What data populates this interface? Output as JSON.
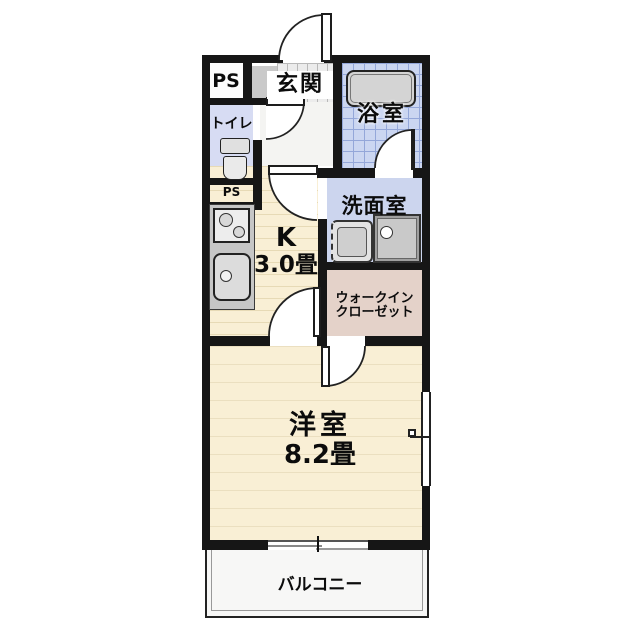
{
  "rooms": {
    "ps_top": {
      "label": "PS"
    },
    "entrance": {
      "label": "玄関"
    },
    "bathroom": {
      "label": "浴室"
    },
    "toilet": {
      "label": "トイレ"
    },
    "ps_lower": {
      "label": "PS"
    },
    "washroom": {
      "label": "洗面室"
    },
    "kitchen": {
      "type_label": "K",
      "size_label": "3.0畳"
    },
    "walk_in_closet": {
      "label_line1": "ウォークイン",
      "label_line2": "クローゼット"
    },
    "western_room": {
      "label": "洋室",
      "size_label": "8.2畳"
    },
    "balcony": {
      "label": "バルコニー"
    }
  },
  "fixtures": [
    "bathtub",
    "toilet-bowl",
    "stove-burners",
    "kitchen-sink",
    "washing-machine-space",
    "vanity-sink"
  ],
  "colors": {
    "wall": "#161616",
    "kitchen_floor": "#f9efd5",
    "western_room_floor": "#f9efd5",
    "bathroom_floor": "#cbd6f1",
    "washroom_floor": "#ccd5ee",
    "toilet_floor": "#d7dcf3",
    "closet_floor": "#e4d2c9",
    "entrance_tile": "#ececec",
    "fixture_gray": "#cccccc"
  }
}
